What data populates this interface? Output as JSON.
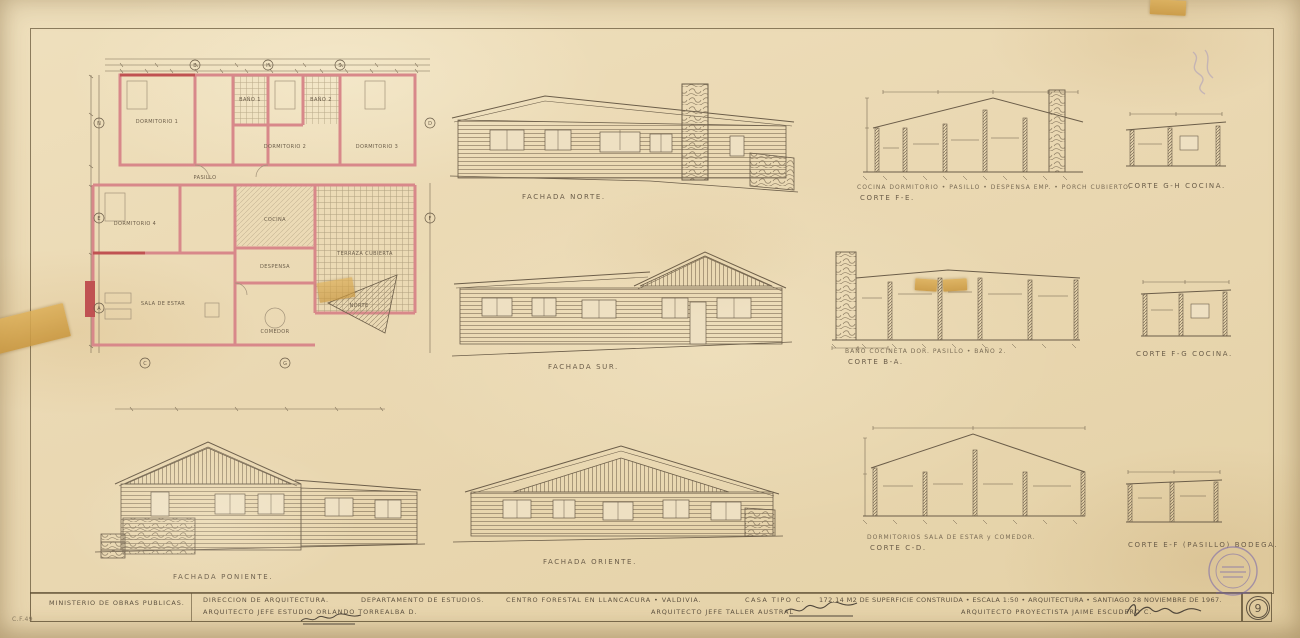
{
  "sheet": {
    "number": "9",
    "corner_code": "C.F.49"
  },
  "plan": {
    "north_label": "NORTE",
    "rooms": {
      "dorm1": "DORMITORIO 1",
      "dorm2": "DORMITORIO 2",
      "dorm3": "DORMITORIO 3",
      "dorm4": "DORMITORIO 4",
      "bano1": "BAÑO 1",
      "bano2": "BAÑO 2",
      "pasillo": "PASILLO",
      "cocina": "COCINA",
      "despensa": "DESPENSA",
      "comedor": "COMEDOR",
      "sala": "SALA DE ESTAR",
      "terraza": "TERRAZA CUBIERTA"
    },
    "markers": [
      "B",
      "H",
      "S",
      "N",
      "E",
      "A",
      "D",
      "F",
      "C",
      "G"
    ]
  },
  "elevations": {
    "norte": "FACHADA NORTE.",
    "sur": "FACHADA SUR.",
    "poniente": "FACHADA PONIENTE.",
    "oriente": "FACHADA ORIENTE."
  },
  "sections": {
    "fe": {
      "caption": "COCINA DORMITORIO • PASILLO • DESPENSA EMP. • PORCH CUBIERTO.",
      "label": "CORTE  F-E."
    },
    "gh": {
      "label": "CORTE  G-H  COCINA."
    },
    "ba": {
      "caption": "BAÑO COCINETA   DOR.   PASILLO • BAÑO 2.",
      "label": "CORTE  B-A."
    },
    "fg": {
      "label": "CORTE  F-G  COCINA."
    },
    "cd": {
      "caption": "DORMITORIOS   SALA DE ESTAR  y  COMEDOR.",
      "label": "CORTE  C-D."
    },
    "ef": {
      "label": "CORTE  E-F  (PASILLO) BODEGA."
    }
  },
  "titleblock": {
    "ministry": "MINISTERIO DE OBRAS PUBLICAS.",
    "direction": "DIRECCION DE ARQUITECTURA.",
    "chief_studio": "ARQUITECTO JEFE ESTUDIO   ORLANDO TORREALBA D.",
    "department": "DEPARTAMENTO DE ESTUDIOS.",
    "project": "CENTRO FORESTAL EN LLANCACURA • VALDIVIA.",
    "chief_taller": "ARQUITECTO JEFE TALLER AUSTRAL",
    "house_type": "CASA TIPO C.",
    "details": "172.14 M2 DE SUPERFICIE CONSTRUIDA  •  ESCALA 1:50  •  ARQUITECTURA  •  SANTIAGO 28 NOVIEMBRE DE 1967.",
    "designer": "ARQUITECTO PROYECTISTA   JAIME ESCUDERO C."
  }
}
